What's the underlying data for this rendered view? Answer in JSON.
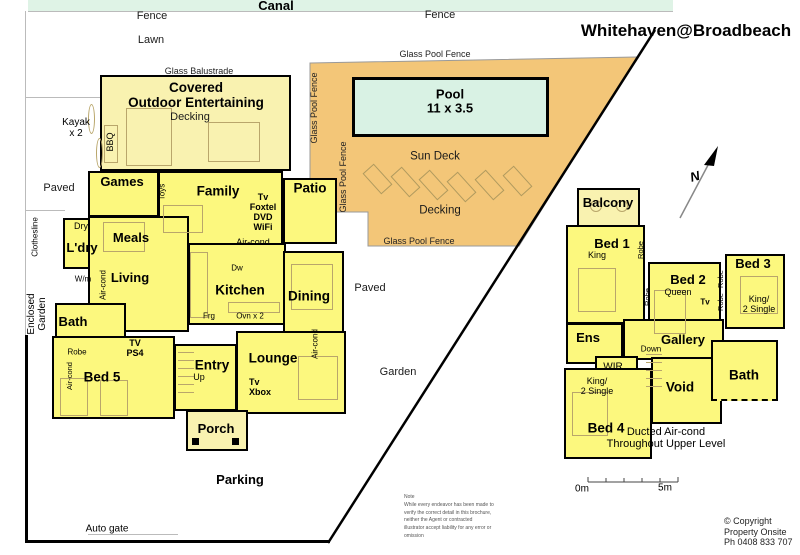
{
  "title": "Whitehaven@Broadbeach",
  "site": {
    "canal": "Canal",
    "fence": "Fence",
    "lawn": "Lawn",
    "glass_balustrade": "Glass Balustrade",
    "glass_pool_fence": "Glass Pool Fence",
    "kayak": "Kayak\nx 2",
    "paved": "Paved",
    "clothesline": "Clothesline",
    "enclosed_garden": "Enclosed\nGarden",
    "garden": "Garden",
    "parking": "Parking",
    "auto_gate": "Auto gate",
    "north": "N"
  },
  "pool_area": {
    "pool": "Pool\n11 x 3.5",
    "sun_deck": "Sun Deck",
    "decking": "Decking"
  },
  "ground_floor": {
    "covered": "Covered\nOutdoor Entertaining",
    "decking": "Decking",
    "bbq": "BBQ",
    "games": "Games",
    "toys": "Toys",
    "family": "Family",
    "family_tech": "Tv\nFoxtel\nDVD\nWiFi",
    "patio": "Patio",
    "aircond": "Air-cond",
    "dry": "Dry",
    "ldry": "L'dry",
    "wm": "W/m",
    "meals": "Meals",
    "living": "Living",
    "kitchen": "Kitchen",
    "dw": "Dw",
    "frg": "Frg",
    "ovn": "Ovn x 2",
    "dining": "Dining",
    "bath": "Bath",
    "robe": "Robe",
    "tv_ps4": "TV\nPS4",
    "bed5": "Bed 5",
    "entry": "Entry",
    "up": "Up",
    "lounge": "Lounge",
    "tv_xbox": "Tv\nXbox",
    "porch": "Porch"
  },
  "upper_floor": {
    "balcony": "Balcony",
    "bed1": "Bed 1",
    "king": "King",
    "robe": "Robe",
    "bed2": "Bed 2",
    "queen": "Queen",
    "tv": "Tv",
    "bed3": "Bed 3",
    "king_2single": "King/\n2 Single",
    "ens": "Ens",
    "gallery": "Gallery",
    "down": "Down",
    "wir": "WIR",
    "void": "Void",
    "bath": "Bath",
    "bed4": "Bed 4",
    "ducted": "Ducted Air-cond\nThroughout Upper Level"
  },
  "footer": {
    "scale_0": "0m",
    "scale_5": "5m",
    "note": "Note\nWhile every endeavor has been made to\nverify the correct detail in this brochure,\nneither the Agent or contracted\nillustrator accept liability for any error or\nomission",
    "copyright": "© Copyright\nProperty Onsite\nPh 0408 833 707"
  },
  "colors": {
    "room_yellow": "#FCF87E",
    "pale_yellow": "#F9F2B0",
    "deck_orange": "#F3C678",
    "pool_mint": "#D9F2E4",
    "canal_green": "#DFF3E6",
    "wall": "#000000"
  }
}
